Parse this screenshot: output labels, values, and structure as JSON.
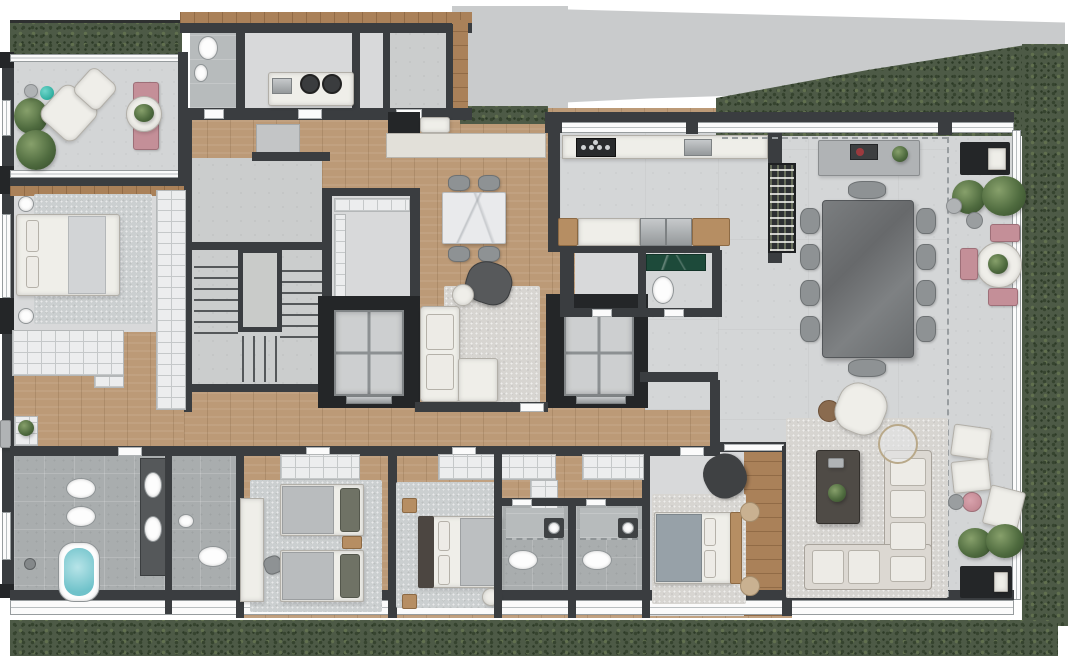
{
  "document": {
    "kind": "residential-floor-plan-render",
    "view": "top-down",
    "visible_text": "none"
  },
  "palette": {
    "wall": "#3a3d40",
    "wall_dark": "#242628",
    "wood": "#bc9a77",
    "deck": "#aa8159",
    "floor": "#d8d9da",
    "concrete": "#cbcdcd",
    "terrace": "#d3d5d6",
    "stone": "#a9adae",
    "hedge": "#4d5a46",
    "rug": "#cbcfd0",
    "white_furniture": "#efeee9",
    "pink": "#c48f98",
    "teal": "#2fae9f",
    "water": "#84ccd3",
    "marble_green": "#1d4a3a",
    "steel": "#b3b6b8",
    "table_stone": "#727577",
    "slab": "#c9cbcc",
    "window": "#fbfbfb"
  },
  "rooms": [
    {
      "name": "terrace-top-left",
      "floor": "concrete"
    },
    {
      "name": "bedroom-left",
      "floor": "light"
    },
    {
      "name": "closet-hall-left",
      "floor": "wood"
    },
    {
      "name": "service-bathroom",
      "floor": "stone"
    },
    {
      "name": "laundry",
      "floor": "light"
    },
    {
      "name": "storage-room",
      "floor": "concrete"
    },
    {
      "name": "stair-hall",
      "floor": "concrete"
    },
    {
      "name": "foyer",
      "floor": "concrete"
    },
    {
      "name": "family-dining-lounge",
      "floor": "wood"
    },
    {
      "name": "kitchen",
      "floor": "concrete"
    },
    {
      "name": "powder-room",
      "floor": "stone"
    },
    {
      "name": "great-room",
      "floor": "porcelain"
    },
    {
      "name": "terrace-right",
      "floor": "concrete"
    },
    {
      "name": "corridor-bedrooms",
      "floor": "wood"
    },
    {
      "name": "master-bathroom",
      "floor": "stone"
    },
    {
      "name": "twin-bedroom",
      "floor": "wood"
    },
    {
      "name": "double-bedroom",
      "floor": "wood"
    },
    {
      "name": "ensuite-bath-1",
      "floor": "stone"
    },
    {
      "name": "ensuite-bath-2",
      "floor": "stone"
    },
    {
      "name": "suite-bedroom",
      "floor": "light"
    },
    {
      "name": "living-room",
      "floor": "porcelain"
    }
  ],
  "furniture": [
    "armchair",
    "ottoman",
    "pink-chaise",
    "round-table",
    "bed",
    "nightstand",
    "wardrobe",
    "stairs",
    "elevator",
    "dining-table",
    "dining-chair",
    "sofa",
    "coffee-table",
    "cooktop",
    "kitchen-sink",
    "kitchen-island",
    "wine-rack",
    "sideboard",
    "grill-cabinet",
    "bathtub",
    "toilet",
    "bidet",
    "sink",
    "shower",
    "twin-bed",
    "desk",
    "fire-table",
    "lounge-chair",
    "planter-hedge"
  ]
}
